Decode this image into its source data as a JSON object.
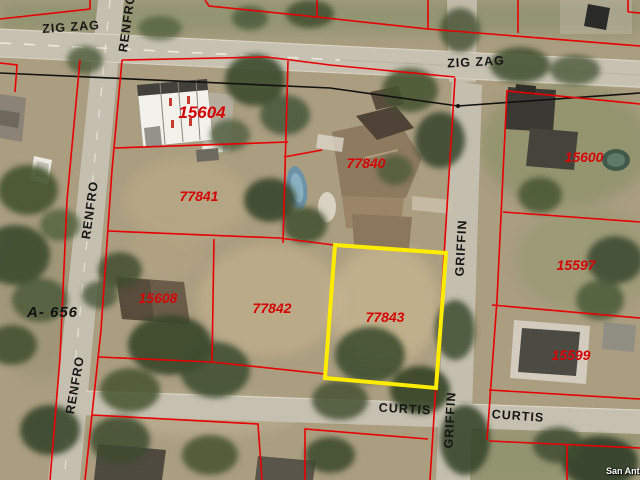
{
  "map": {
    "selected_parcel_id": "77843",
    "survey_label": "A- 656",
    "watermark": "San Anto",
    "colors": {
      "parcel_line": "#e80000",
      "selected_parcel_outline": "#ffec00",
      "parcel_label": "#d40000",
      "road_label": "#161616"
    },
    "parcel_labels": [
      {
        "id": "15604",
        "x": 202,
        "y": 113,
        "large": true
      },
      {
        "id": "77841",
        "x": 199,
        "y": 196
      },
      {
        "id": "77840",
        "x": 366,
        "y": 163
      },
      {
        "id": "15600",
        "x": 584,
        "y": 157
      },
      {
        "id": "15597",
        "x": 576,
        "y": 265
      },
      {
        "id": "15599",
        "x": 571,
        "y": 355
      },
      {
        "id": "15608",
        "x": 158,
        "y": 298
      },
      {
        "id": "77842",
        "x": 272,
        "y": 308
      },
      {
        "id": "77843",
        "x": 385,
        "y": 317
      }
    ],
    "road_labels": [
      {
        "name": "ZIG ZAG",
        "x": 71,
        "y": 27,
        "rot": -4
      },
      {
        "name": "ZIG ZAG",
        "x": 476,
        "y": 62,
        "rot": -3
      },
      {
        "name": "RENFRO",
        "x": 127,
        "y": 23,
        "rot": -82
      },
      {
        "name": "RENFRO",
        "x": 90,
        "y": 210,
        "rot": -82
      },
      {
        "name": "RENFRO",
        "x": 75,
        "y": 385,
        "rot": -80
      },
      {
        "name": "GRIFFIN",
        "x": 461,
        "y": 248,
        "rot": -87
      },
      {
        "name": "GRIFFIN",
        "x": 450,
        "y": 420,
        "rot": -87
      },
      {
        "name": "CURTIS",
        "x": 405,
        "y": 409,
        "rot": 3
      },
      {
        "name": "CURTIS",
        "x": 518,
        "y": 416,
        "rot": 4
      }
    ]
  }
}
